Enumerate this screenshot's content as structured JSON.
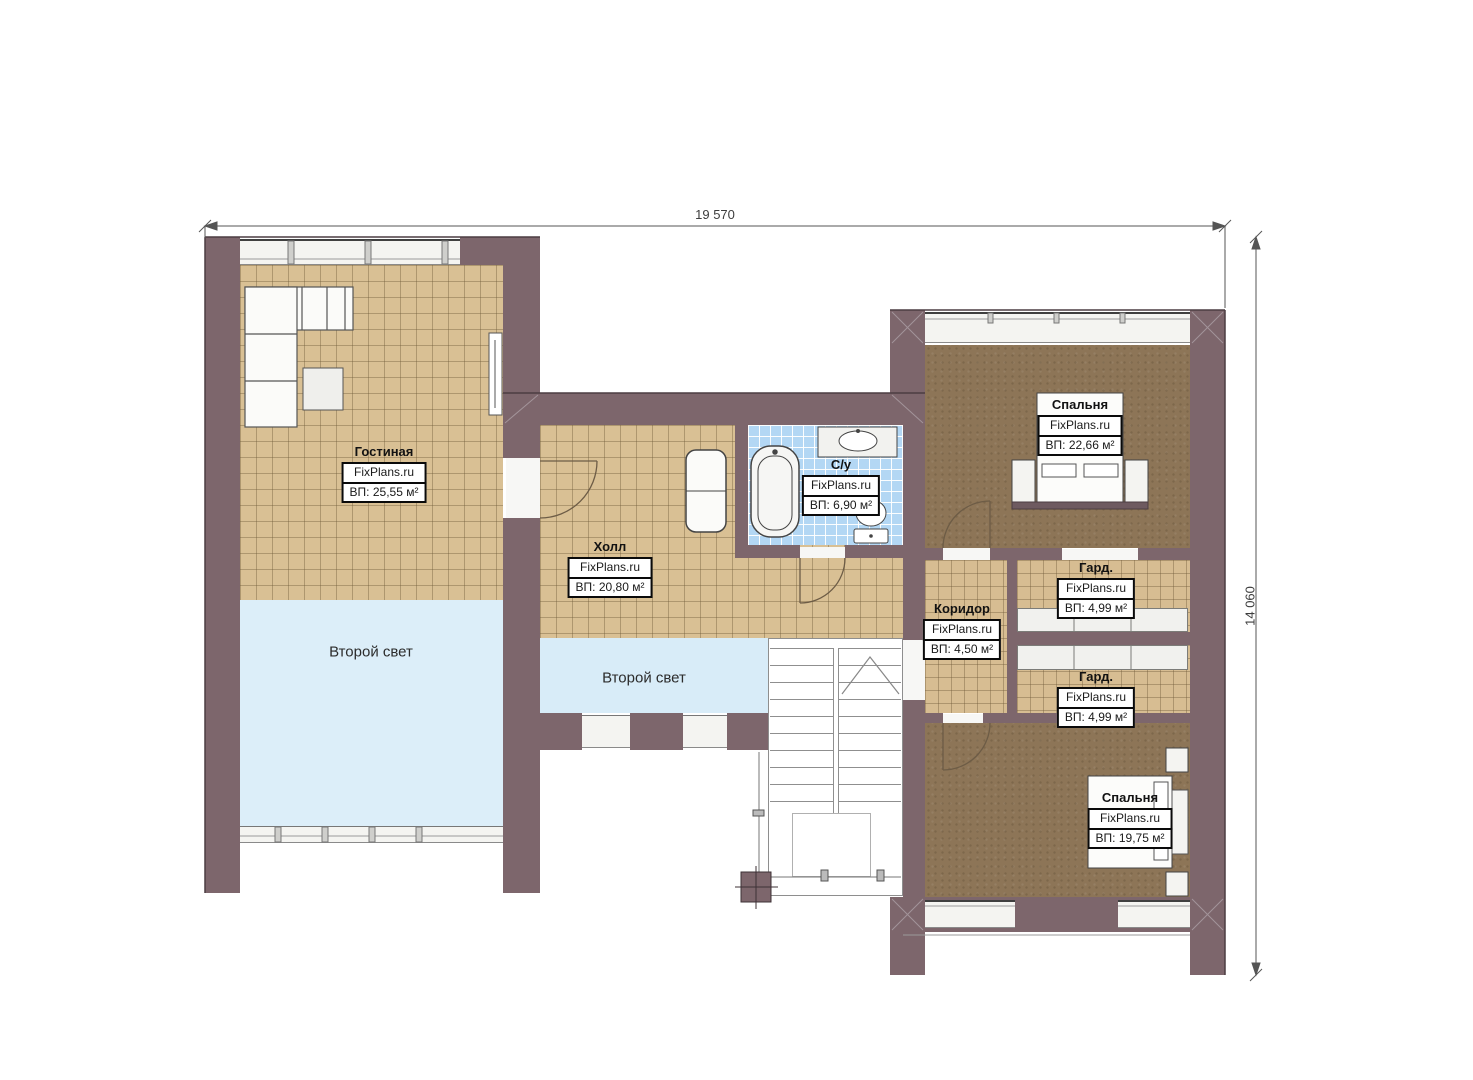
{
  "plan": {
    "dimensions": {
      "width_label": "19 570",
      "height_label": "14 060"
    },
    "brand": "FixPlans.ru",
    "colors": {
      "wall": "#7d666c",
      "floor_tile": "#d9c094",
      "bath_tile": "#b3d7f4",
      "carpet": "#8d7557",
      "void_fill": "#dceef9",
      "label_border": "#0a0a0a"
    },
    "rooms": {
      "living": {
        "name": "Гостиная",
        "brand": "FixPlans.ru",
        "area": "ВП: 25,55 м²"
      },
      "hall": {
        "name": "Холл",
        "brand": "FixPlans.ru",
        "area": "ВП: 20,80 м²"
      },
      "bathroom": {
        "name": "С/у",
        "brand": "FixPlans.ru",
        "area": "ВП: 6,90 м²"
      },
      "bedroom_top": {
        "name": "Спальня",
        "brand": "FixPlans.ru",
        "area": "ВП: 22,66 м²"
      },
      "corridor": {
        "name": "Коридор",
        "brand": "FixPlans.ru",
        "area": "ВП: 4,50 м²"
      },
      "wardrobe_top": {
        "name": "Гард.",
        "brand": "FixPlans.ru",
        "area": "ВП: 4,99 м²"
      },
      "wardrobe_bottom": {
        "name": "Гард.",
        "brand": "FixPlans.ru",
        "area": "ВП: 4,99 м²"
      },
      "bedroom_bottom": {
        "name": "Спальня",
        "brand": "FixPlans.ru",
        "area": "ВП: 19,75 м²"
      }
    },
    "voids": {
      "left": "Второй свет",
      "middle": "Второй свет"
    }
  }
}
